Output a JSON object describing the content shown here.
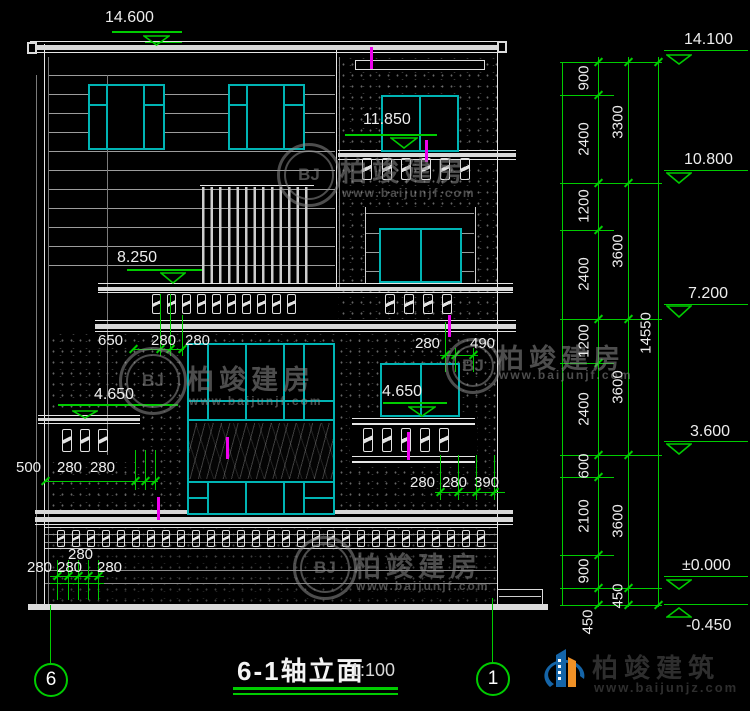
{
  "drawing": {
    "title": "6-1轴立面",
    "scale": "1:100",
    "axis_left": "6",
    "axis_right": "1"
  },
  "elevations": {
    "left": [
      "14.600",
      "11.850",
      "8.250",
      "4.650",
      "4.650"
    ],
    "right": [
      "14.100",
      "10.800",
      "7.200",
      "3.600",
      "±0.000",
      "-0.450"
    ]
  },
  "dim_chain": {
    "inner": [
      "900",
      "2400",
      "1200",
      "2400",
      "1200",
      "2400",
      "600",
      "2100",
      "900"
    ],
    "mid": [
      "3300",
      "3600",
      "3600",
      "3600",
      "450"
    ],
    "total": "14550",
    "extra_450": "450"
  },
  "dims": {
    "mid_left": [
      "650",
      "280",
      "280"
    ],
    "mid_right": [
      "280",
      "490"
    ],
    "left_lower": [
      "500",
      "280",
      "280"
    ],
    "bottom_left_top": "280",
    "bottom_left": [
      "280",
      "280",
      "280"
    ],
    "bottom_right": [
      "280",
      "280",
      "390"
    ]
  },
  "watermark": {
    "badge": "BJ",
    "name": "柏竣建房",
    "url": "www.baijunjf.com"
  },
  "brand": {
    "name": "柏竣建筑",
    "url": "www.baijunjz.com"
  },
  "colors": {
    "line": "#e6e6e6",
    "glass": "#00b4b4",
    "dim": "#00cc00",
    "marker": "#ee00ee",
    "wm": "#8c8c8c",
    "brand_blue": "#1565a8",
    "brand_orange": "#f09126"
  }
}
